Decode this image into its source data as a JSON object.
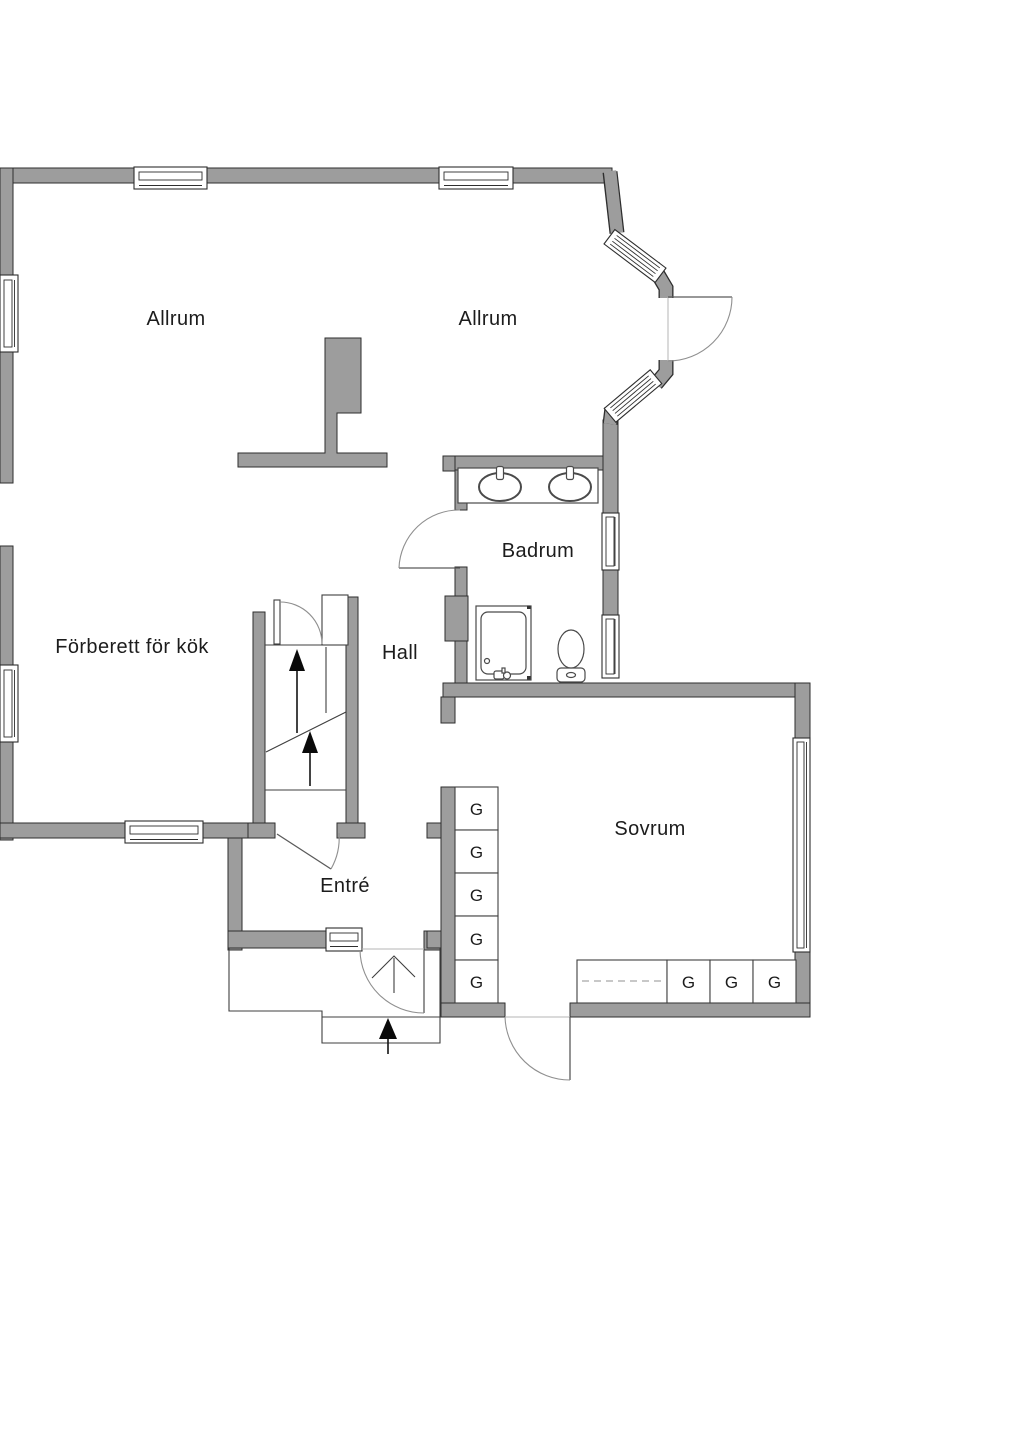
{
  "document": {
    "kind": "floor-plan",
    "language": "sv"
  },
  "colors": {
    "background": "#ffffff",
    "wall_fill": "#9d9d9d",
    "wall_outline": "#2e2e2e",
    "thin_line": "#3f3f3f",
    "door_arc": "#8f8f8f",
    "dashed_line": "#a6a6a6",
    "arrow_fill": "#0a0a0a",
    "text": "#1c1c1c"
  },
  "rooms": {
    "allrum_left": {
      "label": "Allrum"
    },
    "allrum_right": {
      "label": "Allrum"
    },
    "badrum": {
      "label": "Badrum"
    },
    "forberett_for_kok": {
      "label": "Förberett för kök"
    },
    "hall": {
      "label": "Hall"
    },
    "entre": {
      "label": "Entré"
    },
    "sovrum": {
      "label": "Sovrum"
    }
  },
  "wardrobes": {
    "items": [
      {
        "label": "G"
      },
      {
        "label": "G"
      },
      {
        "label": "G"
      },
      {
        "label": "G"
      },
      {
        "label": "G"
      },
      {
        "label": "G"
      },
      {
        "label": "G"
      },
      {
        "label": "G"
      }
    ]
  }
}
